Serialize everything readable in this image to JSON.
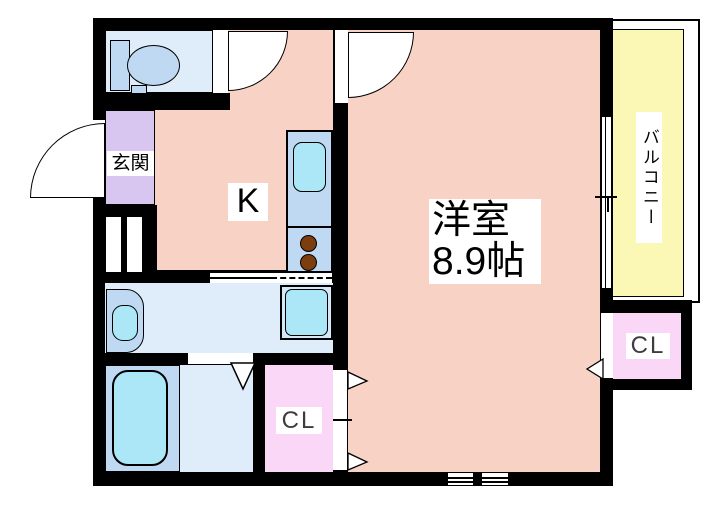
{
  "plan": {
    "labels": {
      "entrance": "玄関",
      "kitchen": "K",
      "main_room_name": "洋室",
      "main_room_size": "8.9帖",
      "balcony": "バルコニー",
      "closet_bottom": "CL",
      "closet_right": "CL"
    },
    "fixtures": [
      "toilet-icon",
      "kitchen-sink-icon",
      "stove-burner-icon",
      "wash-basin-icon",
      "washing-machine-pan-icon",
      "bathtub-icon",
      "door-swing-arc-icon",
      "sliding-window-icon",
      "folding-door-arrow-icon"
    ],
    "colors": {
      "wall": "#000000",
      "room_floor": "#f8d3c5",
      "entrance_floor": "#d9c6f0",
      "balcony_floor": "#fbf7b4",
      "closet_floor": "#fbd7f7",
      "wet_floor": "#deedf9",
      "fixture_blue": "#bfd9f3",
      "fixture_cyan": "#abe7f6",
      "pan_blue": "#d6e7f8",
      "burner_brown": "#7c3d0f",
      "label_text": "#000000",
      "cl_text": "#3d3d3d"
    }
  }
}
